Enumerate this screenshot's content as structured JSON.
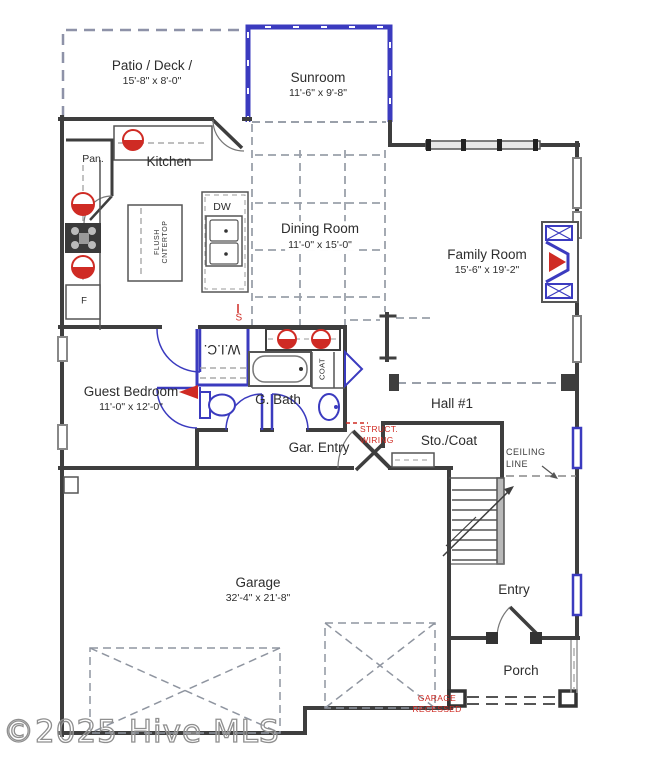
{
  "plan": {
    "watermark": "©2025 Hive MLS",
    "rooms": {
      "patio": {
        "name": "Patio / Deck /",
        "dims": "15'-8\" x 8'-0\""
      },
      "sunroom": {
        "name": "Sunroom",
        "dims": "11'-6\" x 9'-8\""
      },
      "kitchen": {
        "name": "Kitchen"
      },
      "pantry": {
        "name": "Pan."
      },
      "dining_room": {
        "name": "Dining Room",
        "dims": "11'-0\" x 15'-0\""
      },
      "family_room": {
        "name": "Family Room",
        "dims": "15'-6\" x 19'-2\""
      },
      "guest_bedroom": {
        "name": "Guest Bedroom",
        "dims": "11'-0\" x 12'-0\""
      },
      "wic": {
        "name": "W.I.C."
      },
      "guest_bath": {
        "name": "G. Bath"
      },
      "hall": {
        "name": "Hall #1"
      },
      "garage_entry": {
        "name": "Gar. Entry"
      },
      "storage_coat": {
        "name": "Sto./Coat"
      },
      "garage": {
        "name": "Garage",
        "dims": "32'-4\" x 21'-8\""
      },
      "entry": {
        "name": "Entry"
      },
      "porch": {
        "name": "Porch"
      }
    },
    "fixtures": {
      "coat_closet": "COAT",
      "dishwasher": "DW",
      "refrigerator": "F",
      "island_line1": "FLUSH",
      "island_line2": "CNTERTOP"
    },
    "annotations": {
      "struct_wiring_line1": "STRUCT.",
      "struct_wiring_line2": "WIRING",
      "ceiling_line_line1": "CEILING",
      "ceiling_line_line2": "LINE",
      "garage_recessed_line1": "GARAGE",
      "garage_recessed_line2": "RECESSED",
      "switch_symbol": "S"
    },
    "colors": {
      "wall": "#3e3e3e",
      "window_blue": "#3b3bbf",
      "fixture_red": "#cf2b24",
      "dash_gray": "#9aa0aa"
    }
  }
}
